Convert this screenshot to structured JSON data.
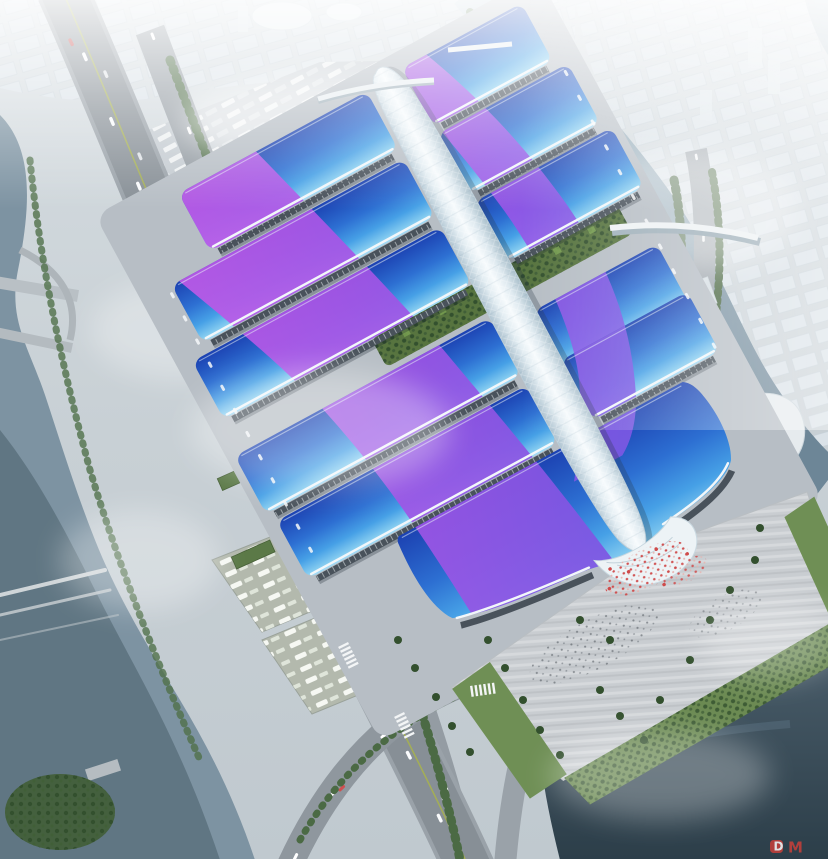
{
  "scene": {
    "type": "aerial-architectural-rendering",
    "subject": "riverside exhibition and convention center complex",
    "description": "Bird's-eye rendering: paired rows of exhibition halls with blue gradient roofs and sweeping purple ribbon graphics flank a central white lattice concourse spine ending in a wave-shaped south entrance hall; entrance plaza with red-clothed crowd and palm trees, green courtyards between halls, truck and bus parking lots, an elevated riverside expressway, canals with bridges, curved white waterfront buildings and a hazy city skyline all around.",
    "atmosphere": "bright hazy daylight"
  },
  "watermark": {
    "logo_letter": "D",
    "text": "M",
    "color": "#c8403a"
  },
  "palette": {
    "roof_blue_deep": "#1c42b2",
    "roof_blue_light": "#a5dcf6",
    "ribbon_purple": "#a655e6",
    "ribbon_magenta": "#cd5ce8",
    "spine_white": "#f7fbfd",
    "water_gray": "#7d93a2",
    "water_dark": "#32444f",
    "road_gray": "#8d969d",
    "plaza_gray": "#c9cdd1",
    "lawn_green": "#6f8f55",
    "tree_green": "#33502e",
    "crowd_red": "#cf4a4a",
    "haze_white": "#f2f6f8"
  }
}
